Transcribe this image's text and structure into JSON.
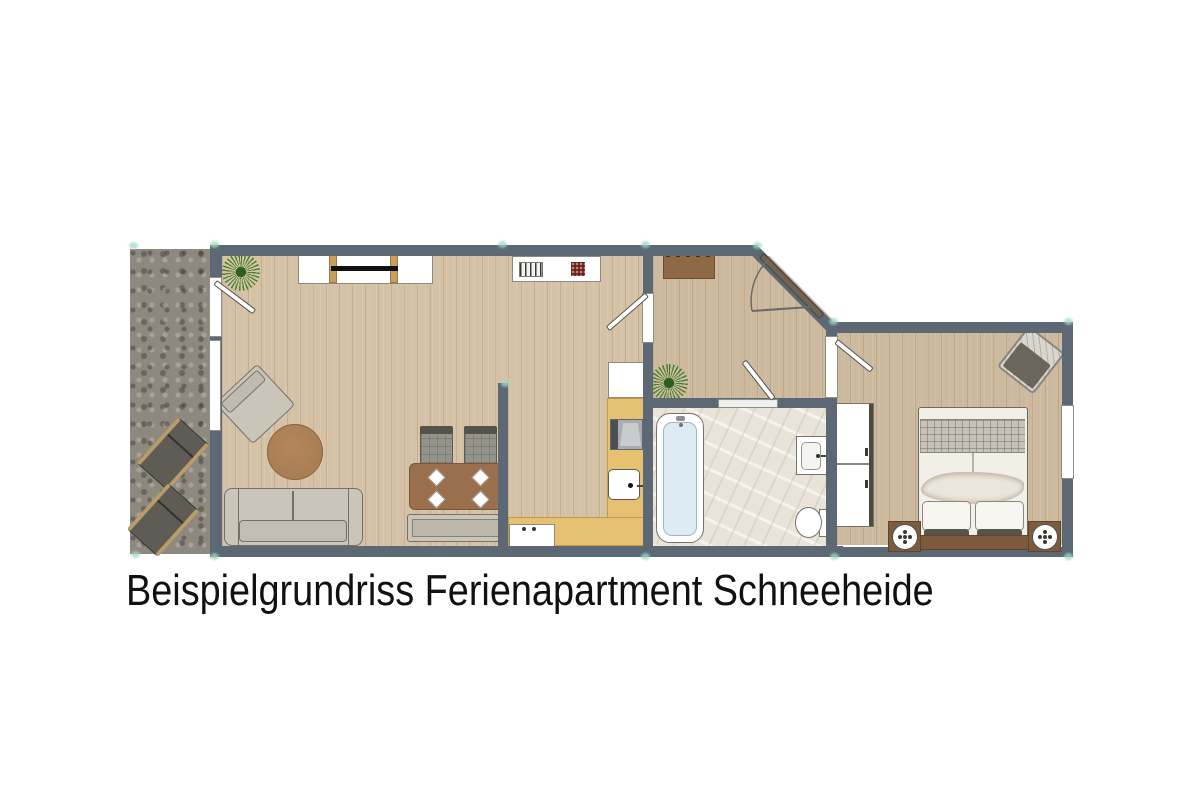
{
  "caption": "Beispielgrundriss Ferienapartment Schneeheide",
  "colors": {
    "wall": "#5c6874",
    "wood": "#d5c2a6",
    "terrace": "#8d897f",
    "marble": "#e9e4d9",
    "counter": "#e6c171",
    "table": "#9a6f4c",
    "rug": "#aa7e54",
    "sofa": "#cac5b9",
    "headboard": "#7d5a3c",
    "rack": "#8f6946",
    "plant": "#44822f",
    "tub": "#dcecf2",
    "entry_door": "#6f6355",
    "marker": "#9fd8c0",
    "text": "#111111"
  },
  "plan": {
    "terrace": {
      "items": [
        "sun-lounger",
        "sun-lounger"
      ]
    },
    "living_room": {
      "items": [
        "plant",
        "tv-sideboard",
        "tv",
        "armchair",
        "round-coffee-table",
        "sofa",
        "dining-table",
        "dining-chair",
        "dining-chair",
        "plates",
        "bench",
        "terrace-door",
        "window"
      ]
    },
    "kitchen": {
      "items": [
        "top-counter",
        "dish-rack",
        "trivet",
        "fridge",
        "stove",
        "sink",
        "l-counter",
        "base-counter"
      ]
    },
    "hallway": {
      "items": [
        "coat-rack",
        "plant",
        "entrance-door",
        "door-to-living",
        "door-to-bedroom",
        "door-to-bathroom"
      ]
    },
    "bathroom": {
      "items": [
        "bathtub",
        "washbasin",
        "toilet"
      ]
    },
    "bedroom": {
      "items": [
        "double-bed",
        "pillows",
        "blanket",
        "headboard",
        "nightstand",
        "nightstand",
        "wardrobe",
        "chair",
        "window"
      ]
    }
  }
}
